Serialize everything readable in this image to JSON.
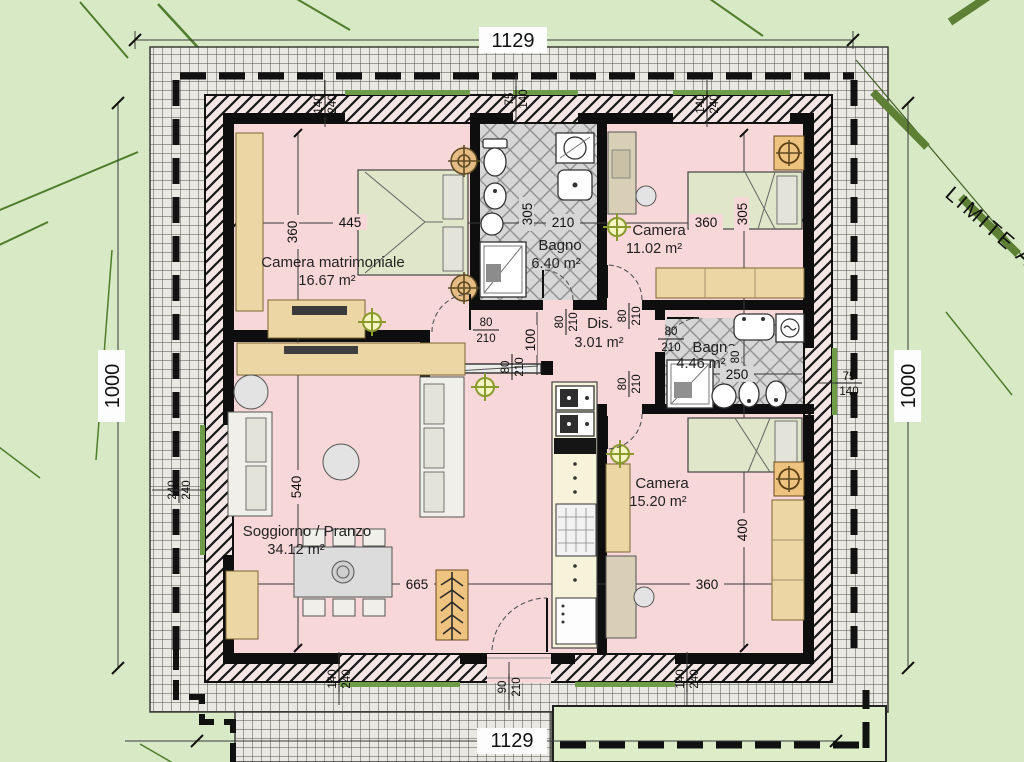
{
  "plan": {
    "boundary_label": "LIMITE A",
    "outer_dims": {
      "top": "1129",
      "bottom": "1129",
      "left": "1000",
      "right": "1000"
    },
    "rooms": {
      "camera_matrimoniale": {
        "name": "Camera matrimoniale",
        "area": "16.67 m²",
        "width": "445",
        "height": "360"
      },
      "bagno1": {
        "name": "Bagno",
        "area": "6.40 m²",
        "width": "210",
        "height": "305"
      },
      "camera2": {
        "name": "Camera",
        "area": "11.02 m²",
        "width": "360",
        "height": "305"
      },
      "dis": {
        "name": "Dis.",
        "area": "3.01 m²",
        "corridor_width": "100"
      },
      "bagno2": {
        "name": "Bagno",
        "area": "4.46 m²",
        "width": "250",
        "fixture": "80"
      },
      "camera3": {
        "name": "Camera",
        "area": "15.20 m²",
        "width": "360",
        "height": "400"
      },
      "soggiorno": {
        "name": "Soggiorno / Pranzo",
        "area": "34.12 m²",
        "width": "665",
        "height": "540"
      }
    },
    "openings": {
      "window_140_240": {
        "w": "140",
        "h": "240"
      },
      "window_75_140": {
        "w": "75",
        "h": "140"
      },
      "window_240_240": {
        "w": "240",
        "h": "240"
      },
      "door_80_210": {
        "w": "80",
        "h": "210"
      },
      "entrance_90_210": {
        "w": "90",
        "h": "210"
      }
    },
    "colors": {
      "background": "#d8e9c5",
      "floor_pink": "#f8d7d8",
      "tile_gray": "#d6d6d6",
      "furniture_wood": "#ecd7a4",
      "bed_green": "#e0e6c9",
      "sill_green": "#6f9c49",
      "boundary_green": "#5e8034"
    }
  }
}
